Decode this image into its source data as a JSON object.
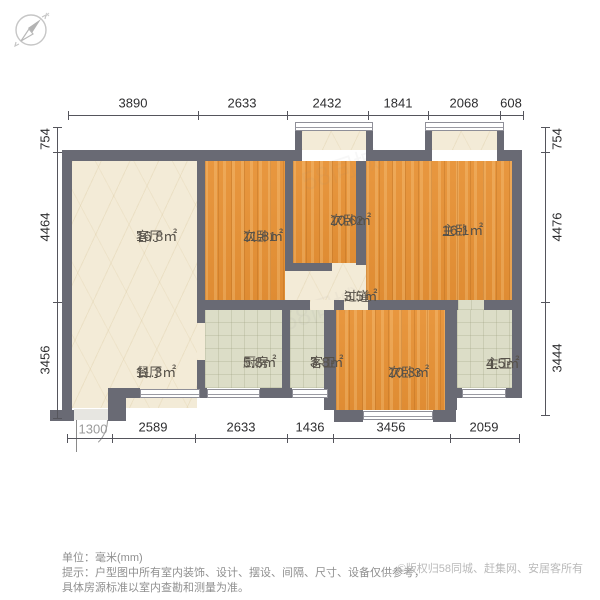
{
  "plan": {
    "unit_note": "单位：毫米(mm)",
    "tip_line1": "提示：户型图中所有室内装饰、设计、摆设、间隔、尺寸、设备仅供参考，",
    "tip_line2": "具体房源标准以室内查勘和测量为准。",
    "copyright": "©版权归58同城、赶集网、安居客所有",
    "watermark": "58同城"
  },
  "rooms": [
    {
      "name": "客厅",
      "area": "16.8㎡"
    },
    {
      "name": "次卧1",
      "area": "11.8㎡"
    },
    {
      "name": "次卧2",
      "area": "10.0㎡"
    },
    {
      "name": "主卧",
      "area": "16.1㎡"
    },
    {
      "name": "过道",
      "area": "3.5㎡"
    },
    {
      "name": "厨房",
      "area": "5.8㎡"
    },
    {
      "name": "客卫",
      "area": "3.8㎡"
    },
    {
      "name": "次卧3",
      "area": "10.3㎡"
    },
    {
      "name": "主卫",
      "area": "4.5㎡"
    },
    {
      "name": "餐厅",
      "area": "11.3㎡"
    }
  ],
  "dims": {
    "top": [
      "3890",
      "2633",
      "2432",
      "1841",
      "2068",
      "608"
    ],
    "bottom": [
      "1300",
      "2589",
      "2633",
      "1436",
      "3456",
      "2059"
    ],
    "left": [
      "754",
      "4464",
      "3456"
    ],
    "right": [
      "754",
      "4476",
      "3444"
    ]
  },
  "colors": {
    "wall": "#696a74",
    "wood": "#e8973f",
    "cream": "#f3ebd7",
    "tile": "#dcddc7",
    "dim_text": "#2e2e30"
  }
}
